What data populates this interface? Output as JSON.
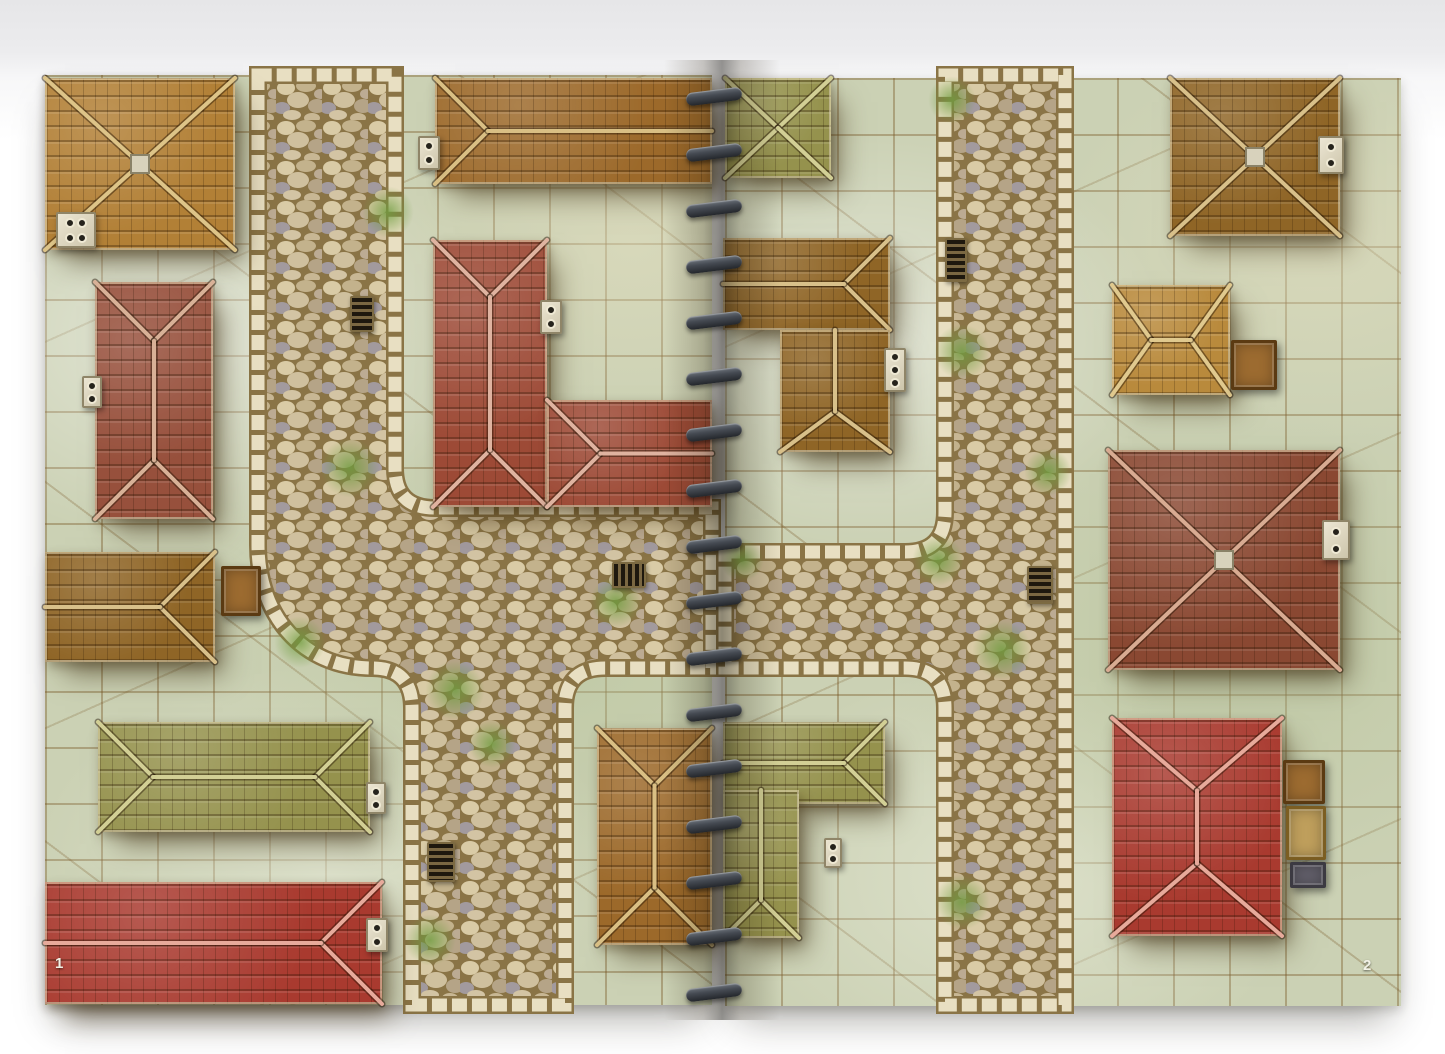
{
  "book": {
    "type": "spiral-bound battle map book, two-page town spread",
    "left_page_number": "1",
    "right_page_number": "2",
    "spine": {
      "coil_count": 17,
      "x": 686,
      "top": 90,
      "spacing": 56,
      "color": "#3c4047"
    }
  },
  "palette": {
    "backdrop_top": "#e6e6e8",
    "ground": "#cbd1b4",
    "ground_line": "#765422",
    "road_grout": "#8a7446",
    "curb": "#e8dfc2",
    "moss": "#6f9c3f",
    "roofs": {
      "gold": {
        "base": "#b28036",
        "ridge": "#ddc488"
      },
      "brown": {
        "base": "#9c692a",
        "ridge": "#d9bf84"
      },
      "brown2": {
        "base": "#8f6526",
        "ridge": "#d8c08a"
      },
      "redbrown": {
        "base": "#97503c",
        "ridge": "#d8b197"
      },
      "red": {
        "base": "#9d4a36",
        "ridge": "#dfb3a0"
      },
      "brightred": {
        "base": "#a93a2f",
        "ridge": "#e7aa9b"
      },
      "darkred": {
        "base": "#8a4832",
        "ridge": "#d8ab92"
      },
      "olive": {
        "base": "#95924d",
        "ridge": "#d2cf95"
      },
      "gold2": {
        "base": "#b98a3c",
        "ridge": "#e0c98e"
      }
    },
    "crate_variants": {
      "wood": {
        "bg": "#9c6b30",
        "border": "#5b3a12"
      },
      "tan": {
        "bg": "#bf9f5c",
        "border": "#7c5e22"
      },
      "dark": {
        "bg": "#63606b",
        "border": "#3c3a42"
      }
    }
  },
  "map": {
    "roads": [
      {
        "id": "left-page-streets",
        "path": "M258,75 L258,545 C258,615 302,668 372,668 Q412,668 412,708 L412,1005 L565,1005 L565,708 Q565,668 605,668 L712,668 L712,508 L435,508 Q395,508 395,468 L395,75 Z"
      },
      {
        "id": "right-page-streets",
        "path": "M725,552 L905,552 Q945,552 945,512 L945,75 L1065,75 L1065,1005 L945,1005 L945,708 Q945,668 905,668 L725,668 Z"
      }
    ],
    "buildings": [
      {
        "id": "left-top-gold-hip",
        "x": 45,
        "y": 78,
        "w": 190,
        "h": 172,
        "type": "hip-x",
        "boss": true,
        "color": "gold"
      },
      {
        "id": "left-top-brown-gable",
        "x": 435,
        "y": 78,
        "w": 277,
        "h": 106,
        "type": "hip-h",
        "cut": [
          "right"
        ],
        "color": "brown"
      },
      {
        "id": "left-mid-redbrown",
        "x": 95,
        "y": 282,
        "w": 118,
        "h": 237,
        "type": "hip-v",
        "color": "redbrown"
      },
      {
        "id": "left-center-red-tall",
        "x": 433,
        "y": 240,
        "w": 114,
        "h": 267,
        "type": "hip-v",
        "color": "red"
      },
      {
        "id": "left-center-red-wing",
        "x": 547,
        "y": 400,
        "w": 165,
        "h": 107,
        "type": "hip-h",
        "cut": [
          "right"
        ],
        "color": "red"
      },
      {
        "id": "left-edge-brown",
        "x": 45,
        "y": 552,
        "w": 170,
        "h": 110,
        "type": "hip-h",
        "cut": [
          "left"
        ],
        "color": "brown2"
      },
      {
        "id": "left-olive-long",
        "x": 98,
        "y": 722,
        "w": 272,
        "h": 110,
        "type": "hip-h",
        "color": "olive"
      },
      {
        "id": "left-bottom-red",
        "x": 45,
        "y": 882,
        "w": 337,
        "h": 122,
        "type": "hip-h",
        "cut": [
          "left"
        ],
        "color": "brightred"
      },
      {
        "id": "left-bottom-brown",
        "x": 597,
        "y": 728,
        "w": 115,
        "h": 217,
        "type": "hip-v",
        "color": "brown"
      },
      {
        "id": "right-olive-top",
        "x": 725,
        "y": 78,
        "w": 106,
        "h": 100,
        "type": "hip-x",
        "color": "olive"
      },
      {
        "id": "right-brown-l-bar",
        "x": 723,
        "y": 238,
        "w": 167,
        "h": 92,
        "type": "hip-h",
        "cut": [
          "left"
        ],
        "color": "brown2"
      },
      {
        "id": "right-brown-l-stem",
        "x": 780,
        "y": 330,
        "w": 110,
        "h": 122,
        "type": "hip-v",
        "cut": [
          "top"
        ],
        "color": "brown2"
      },
      {
        "id": "right-top-brown-hip",
        "x": 1170,
        "y": 78,
        "w": 170,
        "h": 158,
        "type": "hip-x",
        "boss": true,
        "color": "brown2"
      },
      {
        "id": "right-gold-small",
        "x": 1112,
        "y": 285,
        "w": 118,
        "h": 110,
        "type": "hip-h",
        "color": "gold2"
      },
      {
        "id": "right-red-large-hip",
        "x": 1108,
        "y": 450,
        "w": 232,
        "h": 220,
        "type": "hip-x",
        "boss": true,
        "color": "darkred"
      },
      {
        "id": "right-olive-l-bar",
        "x": 723,
        "y": 722,
        "w": 162,
        "h": 82,
        "type": "hip-h",
        "cut": [
          "left"
        ],
        "color": "olive"
      },
      {
        "id": "right-olive-l-stem",
        "x": 723,
        "y": 790,
        "w": 76,
        "h": 148,
        "type": "hip-v",
        "cut": [
          "top"
        ],
        "color": "olive"
      },
      {
        "id": "right-bottom-red-hip",
        "x": 1112,
        "y": 718,
        "w": 170,
        "h": 218,
        "type": "hip-v",
        "color": "brightred"
      }
    ],
    "objects": [
      {
        "t": "chimney",
        "dots": 4,
        "x": 56,
        "y": 212,
        "w": 40,
        "h": 36
      },
      {
        "t": "chimney",
        "dots": 2,
        "x": 418,
        "y": 136,
        "w": 22,
        "h": 34
      },
      {
        "t": "chimney",
        "dots": 2,
        "x": 82,
        "y": 376,
        "w": 20,
        "h": 32
      },
      {
        "t": "chimney",
        "dots": 2,
        "x": 540,
        "y": 300,
        "w": 22,
        "h": 34
      },
      {
        "t": "chimney",
        "dots": 2,
        "x": 366,
        "y": 782,
        "w": 20,
        "h": 32
      },
      {
        "t": "chimney",
        "dots": 2,
        "x": 366,
        "y": 918,
        "w": 22,
        "h": 34
      },
      {
        "t": "chimney",
        "dots": 2,
        "x": 1318,
        "y": 136,
        "w": 26,
        "h": 38
      },
      {
        "t": "chimney",
        "dots": 3,
        "x": 884,
        "y": 348,
        "w": 22,
        "h": 44
      },
      {
        "t": "chimney",
        "dots": 2,
        "x": 1322,
        "y": 520,
        "w": 28,
        "h": 40
      },
      {
        "t": "chimney",
        "dots": 2,
        "x": 824,
        "y": 838,
        "w": 18,
        "h": 30
      },
      {
        "t": "grate",
        "x": 350,
        "y": 296,
        "w": 24,
        "h": 36
      },
      {
        "t": "grate",
        "x": 612,
        "y": 562,
        "w": 34,
        "h": 26
      },
      {
        "t": "grate",
        "x": 427,
        "y": 842,
        "w": 28,
        "h": 40
      },
      {
        "t": "grate",
        "x": 945,
        "y": 238,
        "w": 22,
        "h": 44
      },
      {
        "t": "grate",
        "x": 1027,
        "y": 566,
        "w": 26,
        "h": 38
      },
      {
        "t": "crate",
        "variant": "wood",
        "x": 221,
        "y": 566,
        "w": 40,
        "h": 50
      },
      {
        "t": "crate",
        "variant": "wood",
        "x": 1231,
        "y": 340,
        "w": 46,
        "h": 50
      },
      {
        "t": "crate",
        "variant": "wood",
        "x": 1283,
        "y": 760,
        "w": 42,
        "h": 44
      },
      {
        "t": "crate",
        "variant": "tan",
        "x": 1286,
        "y": 806,
        "w": 40,
        "h": 54
      },
      {
        "t": "crate",
        "variant": "dark",
        "x": 1290,
        "y": 862,
        "w": 36,
        "h": 26
      }
    ],
    "moss": [
      {
        "x": 388,
        "y": 212,
        "r": 26
      },
      {
        "x": 350,
        "y": 468,
        "r": 30
      },
      {
        "x": 300,
        "y": 642,
        "r": 26
      },
      {
        "x": 455,
        "y": 690,
        "r": 30
      },
      {
        "x": 492,
        "y": 744,
        "r": 24
      },
      {
        "x": 616,
        "y": 602,
        "r": 26
      },
      {
        "x": 430,
        "y": 940,
        "r": 26
      },
      {
        "x": 952,
        "y": 100,
        "r": 24
      },
      {
        "x": 962,
        "y": 352,
        "r": 28
      },
      {
        "x": 938,
        "y": 560,
        "r": 26
      },
      {
        "x": 1002,
        "y": 650,
        "r": 30
      },
      {
        "x": 1048,
        "y": 472,
        "r": 24
      },
      {
        "x": 962,
        "y": 902,
        "r": 28
      },
      {
        "x": 742,
        "y": 560,
        "r": 22
      }
    ]
  }
}
